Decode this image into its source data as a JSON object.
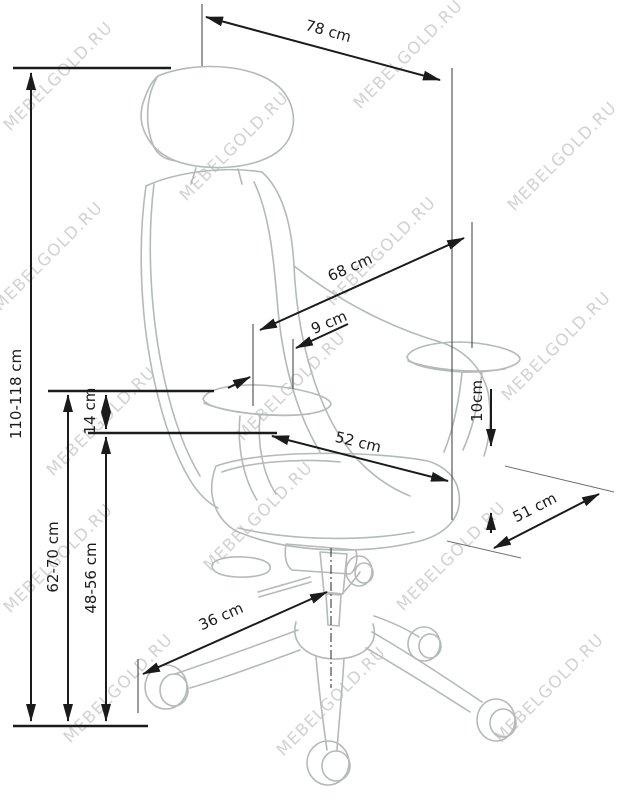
{
  "diagram": {
    "type": "furniture-dimension-drawing",
    "subject": "office ergonomic chair, three-quarter view line art with dimension callouts"
  },
  "watermark": {
    "text": "MEBELGOLD.RU"
  },
  "dimensions": {
    "overall_depth_top": {
      "label": "78 cm"
    },
    "backrest_height": {
      "label": "68 cm"
    },
    "armrest_pad_width": {
      "label": "9 cm"
    },
    "total_height": {
      "label": "110-118 cm"
    },
    "armrest_to_seat": {
      "label": "14 cm"
    },
    "seat_cushion": {
      "label": "10cm"
    },
    "seat_width": {
      "label": "52 cm"
    },
    "seat_depth": {
      "label": "51 cm"
    },
    "armrest_height": {
      "label": "62-70 cm"
    },
    "seat_height": {
      "label": "48-56 cm"
    },
    "base_radius": {
      "label": "36 cm"
    }
  },
  "colors": {
    "background": "#ffffff",
    "dimension_lines": "#1b1b1b",
    "chair_outline": "#b3bab9",
    "watermark": "#c8c8c8"
  }
}
